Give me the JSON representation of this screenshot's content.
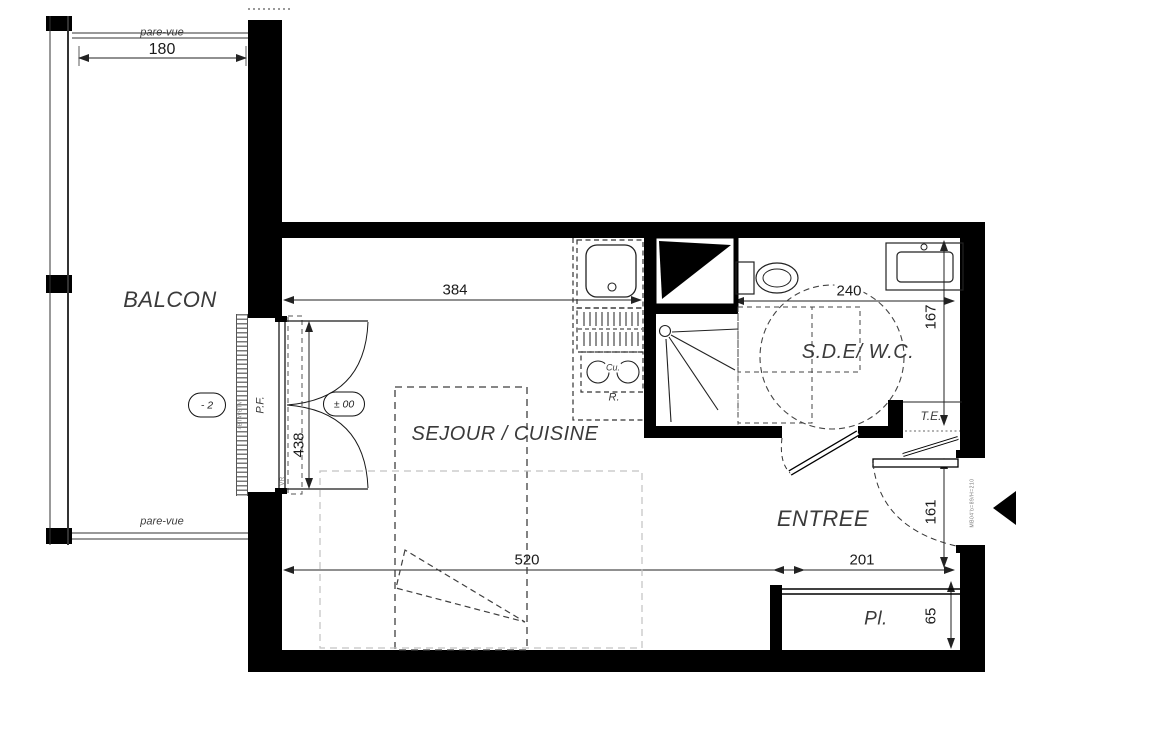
{
  "rooms": {
    "balcon": "BALCON",
    "sejour": "SEJOUR / CUISINE",
    "sde": "S.D.E/ W.C.",
    "entree": "ENTREE",
    "placard": "Pl.",
    "tableau_electrique": "T.E."
  },
  "dimensions": {
    "balcony_width": "180",
    "sejour_width": "384",
    "sde_width": "240",
    "sde_depth": "167",
    "bay_height": "438",
    "sejour_length": "520",
    "entree_width": "201",
    "entree_depth": "161",
    "placard_depth": "65"
  },
  "annotations": {
    "pare_vue_top": "pare-vue",
    "pare_vue_bottom": "pare-vue",
    "window_label": "P.F.",
    "level_main": "± 00",
    "level_balcony": "- 2",
    "fridge": "R.",
    "cooktop": "Cu.",
    "roller_shutter": "VR",
    "window_code": "4BTAVBTV",
    "door_code": "MB04'b=89/H=210"
  },
  "colors": {
    "wall": "#000000",
    "line": "#1a1a1a",
    "dim_line": "#222222",
    "dashed": "#444444",
    "light_dashed": "#c2c2c2",
    "hatch": "#7a7a7a",
    "label": "#3a3a3a"
  }
}
